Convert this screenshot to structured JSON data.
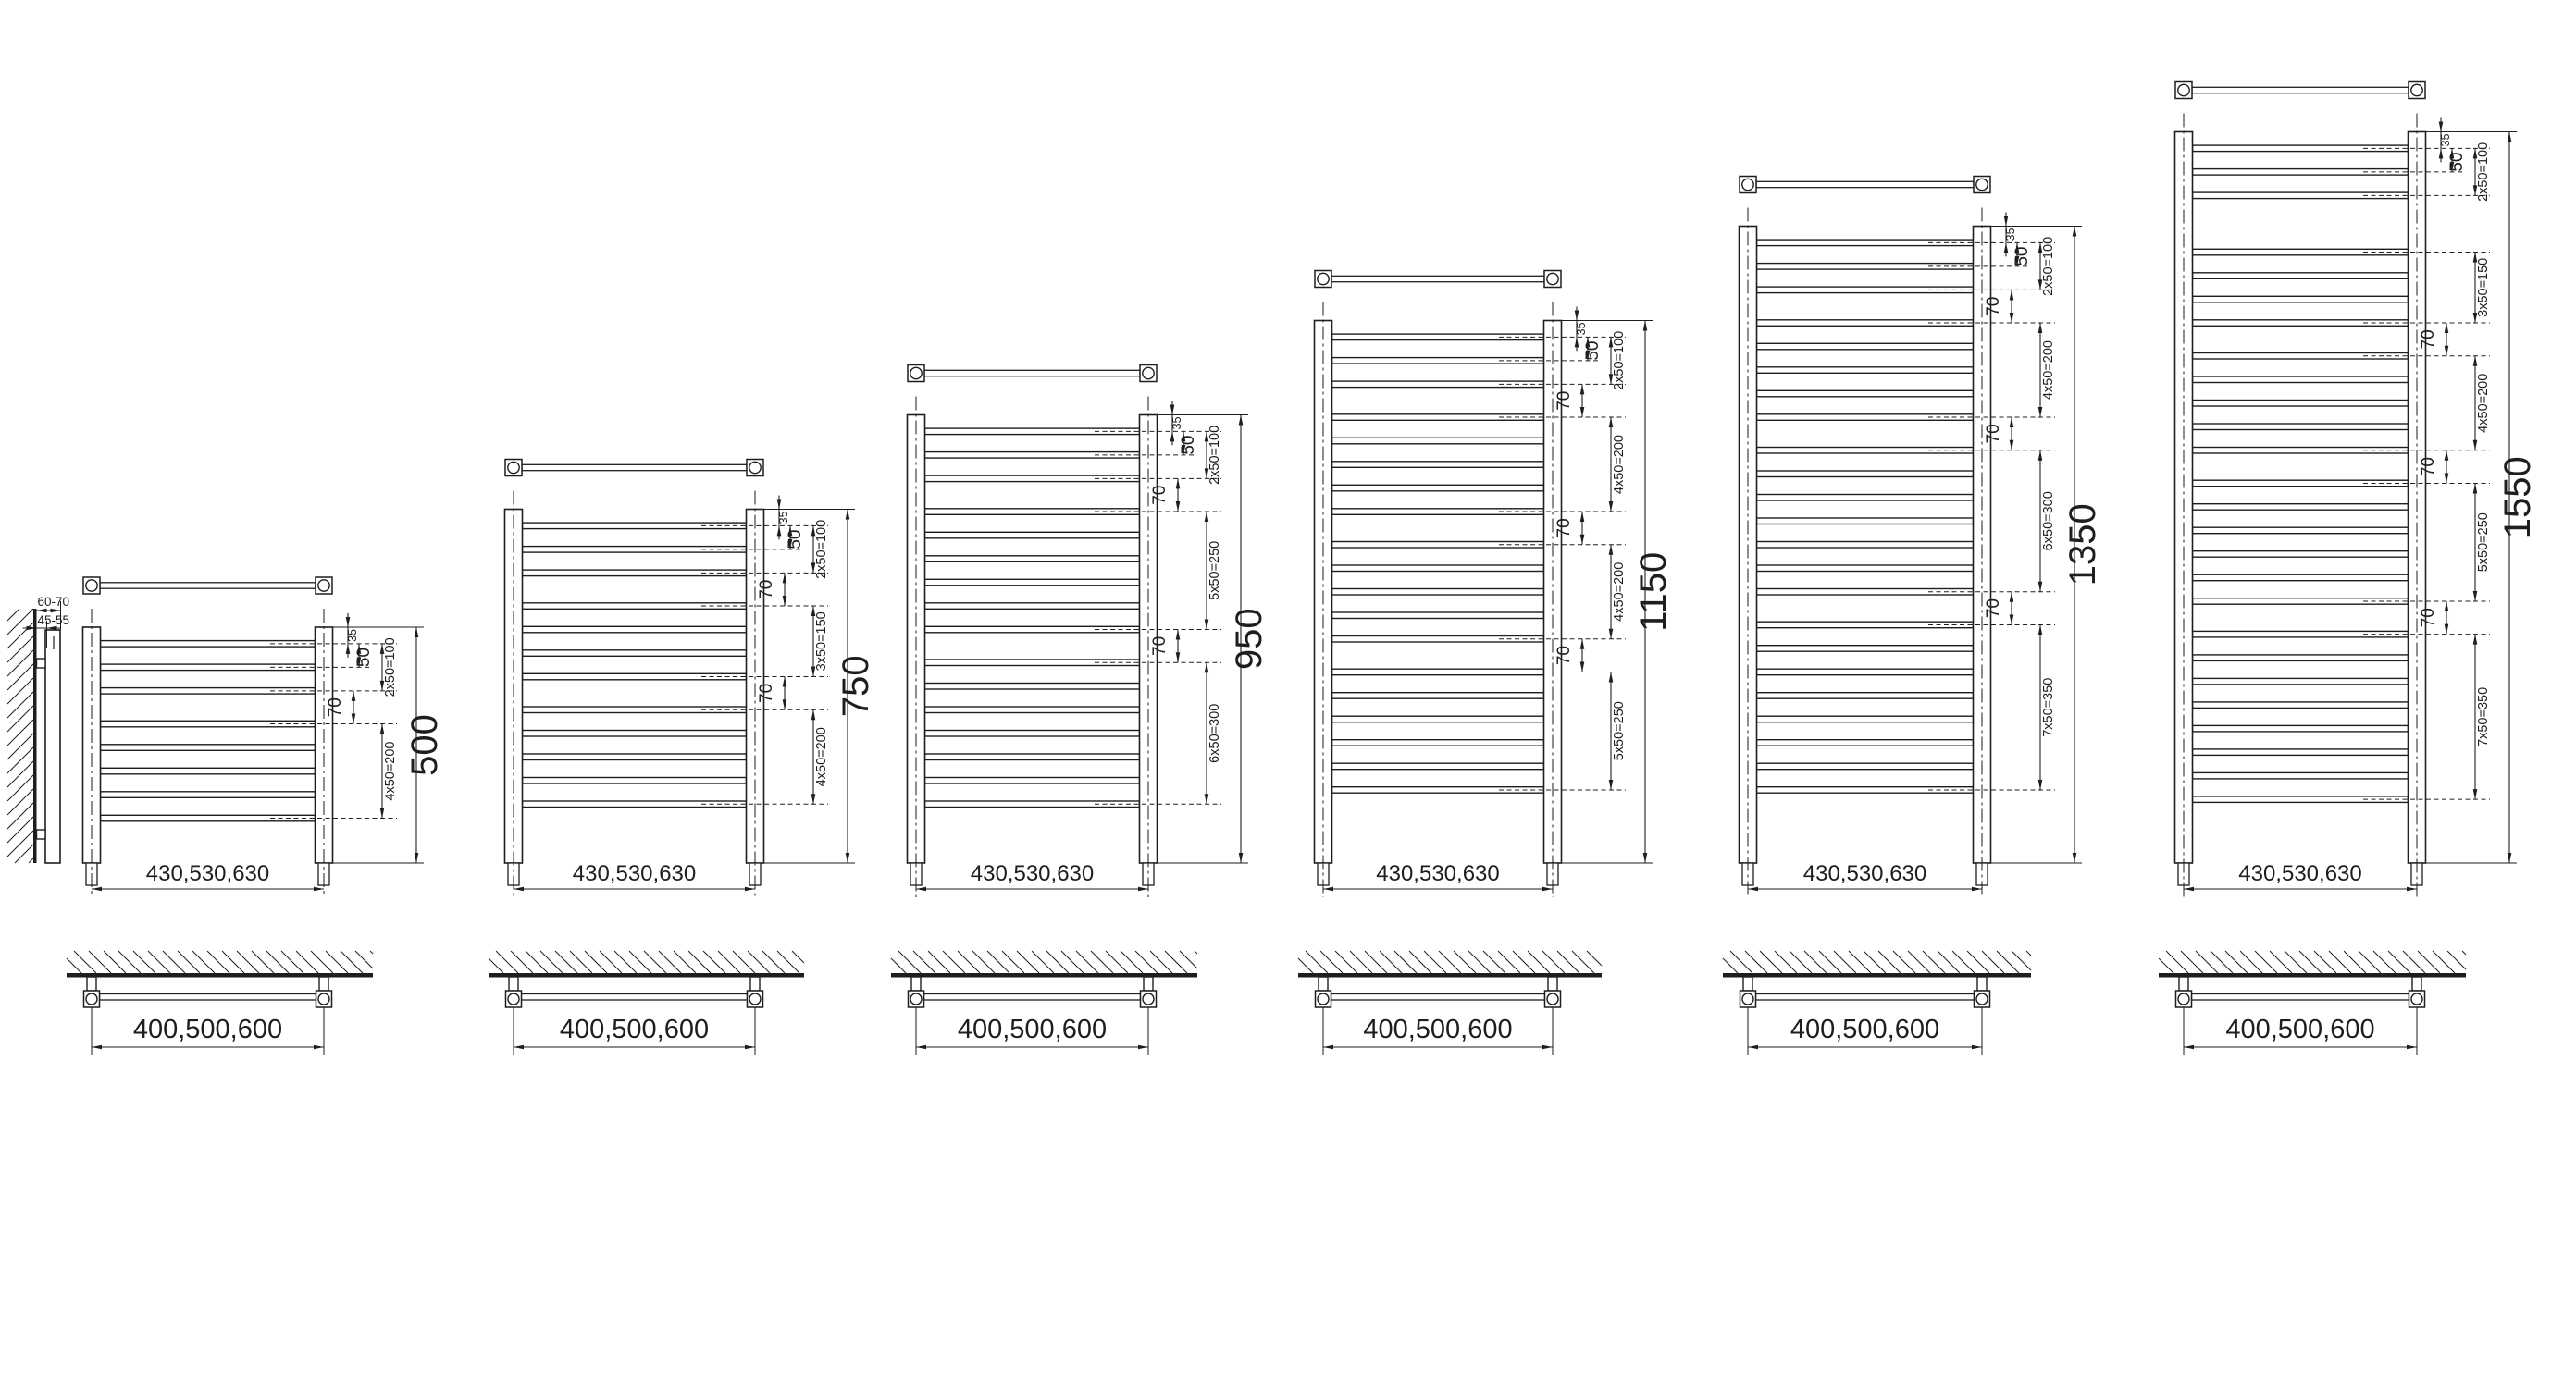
{
  "drawing": {
    "colors": {
      "line": "#1e1e1e",
      "background": "#ffffff"
    },
    "shared": {
      "pitch_mm": 50,
      "top_offset_mm": 35,
      "top_offset_label": "35",
      "first_pitch_label": "50",
      "width_label": "430,530,630",
      "mount_spacing_label": "400,500,600"
    },
    "side_view": {
      "wall_to_front_label": "60-70",
      "wall_to_rear_label": "45-55"
    },
    "radiators": [
      {
        "height_label": "500",
        "height_mm": 500,
        "segments": [
          {
            "kind": "tubes",
            "count": 3,
            "label": "2x50=100"
          },
          {
            "kind": "gap",
            "mm": 70,
            "label": "70"
          },
          {
            "kind": "tubes",
            "count": 5,
            "label": "4x50=200"
          }
        ]
      },
      {
        "height_label": "750",
        "height_mm": 750,
        "segments": [
          {
            "kind": "tubes",
            "count": 3,
            "label": "2x50=100"
          },
          {
            "kind": "gap",
            "mm": 70,
            "label": "70"
          },
          {
            "kind": "tubes",
            "count": 4,
            "label": "3x50=150"
          },
          {
            "kind": "gap",
            "mm": 70,
            "label": "70"
          },
          {
            "kind": "tubes",
            "count": 5,
            "label": "4x50=200"
          }
        ]
      },
      {
        "height_label": "950",
        "height_mm": 950,
        "segments": [
          {
            "kind": "tubes",
            "count": 3,
            "label": "2x50=100"
          },
          {
            "kind": "gap",
            "mm": 70,
            "label": "70"
          },
          {
            "kind": "tubes",
            "count": 6,
            "label": "5x50=250"
          },
          {
            "kind": "gap",
            "mm": 70,
            "label": "70"
          },
          {
            "kind": "tubes",
            "count": 7,
            "label": "6x50=300"
          }
        ]
      },
      {
        "height_label": "1150",
        "height_mm": 1150,
        "segments": [
          {
            "kind": "tubes",
            "count": 3,
            "label": "2x50=100"
          },
          {
            "kind": "gap",
            "mm": 70,
            "label": "70"
          },
          {
            "kind": "tubes",
            "count": 5,
            "label": "4x50=200"
          },
          {
            "kind": "gap",
            "mm": 70,
            "label": "70"
          },
          {
            "kind": "tubes",
            "count": 5,
            "label": "4x50=200"
          },
          {
            "kind": "gap",
            "mm": 70,
            "label": "70"
          },
          {
            "kind": "tubes",
            "count": 6,
            "label": "5x50=250"
          }
        ]
      },
      {
        "height_label": "1350",
        "height_mm": 1350,
        "segments": [
          {
            "kind": "tubes",
            "count": 3,
            "label": "2x50=100"
          },
          {
            "kind": "gap",
            "mm": 70,
            "label": "70"
          },
          {
            "kind": "tubes",
            "count": 5,
            "label": "4x50=200"
          },
          {
            "kind": "gap",
            "mm": 70,
            "label": "70"
          },
          {
            "kind": "tubes",
            "count": 7,
            "label": "6x50=300"
          },
          {
            "kind": "gap",
            "mm": 70,
            "label": "70"
          },
          {
            "kind": "tubes",
            "count": 8,
            "label": "7x50=350"
          }
        ]
      },
      {
        "height_label": "1550",
        "height_mm": 1550,
        "segments": [
          {
            "kind": "tubes",
            "count": 3,
            "label": "2x50=100"
          },
          {
            "kind": "gap",
            "mm": 120,
            "label": ""
          },
          {
            "kind": "tubes",
            "count": 4,
            "label": "3x50=150"
          },
          {
            "kind": "gap",
            "mm": 70,
            "label": "70"
          },
          {
            "kind": "tubes",
            "count": 5,
            "label": "4x50=200"
          },
          {
            "kind": "gap",
            "mm": 70,
            "label": "70"
          },
          {
            "kind": "tubes",
            "count": 6,
            "label": "5x50=250"
          },
          {
            "kind": "gap",
            "mm": 70,
            "label": "70"
          },
          {
            "kind": "tubes",
            "count": 8,
            "label": "7x50=350"
          }
        ]
      }
    ]
  }
}
